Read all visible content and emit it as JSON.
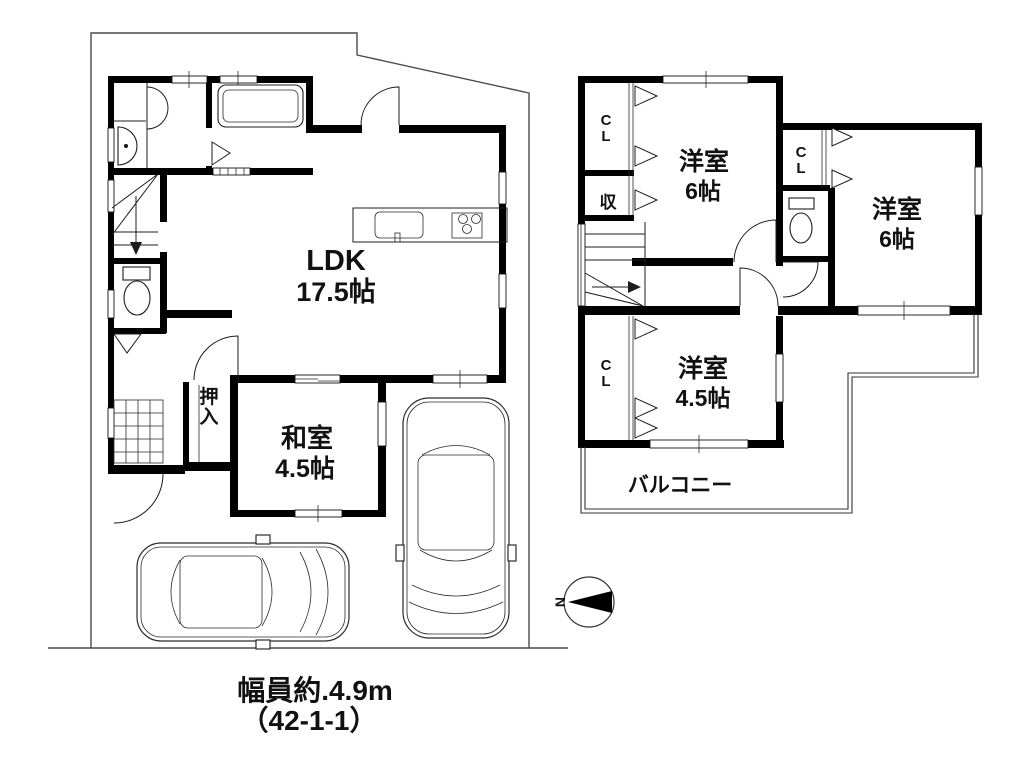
{
  "floor1": {
    "ldk": {
      "name": "LDK",
      "size": "17.5帖"
    },
    "japanese_room": {
      "name": "和室",
      "size": "4.5帖"
    },
    "closet": "押入"
  },
  "floor2": {
    "bedroom_a": {
      "name": "洋室",
      "size": "6帖"
    },
    "bedroom_b": {
      "name": "洋室",
      "size": "6帖"
    },
    "bedroom_c": {
      "name": "洋室",
      "size": "4.5帖"
    },
    "closet_a": "CL",
    "closet_b": "CL",
    "closet_c": "CL",
    "storage": "収",
    "balcony": "バルコニー"
  },
  "compass": {
    "north_label": "N"
  },
  "caption": {
    "line1": "幅員約.4.9m",
    "line2": "（42-1-1）"
  }
}
